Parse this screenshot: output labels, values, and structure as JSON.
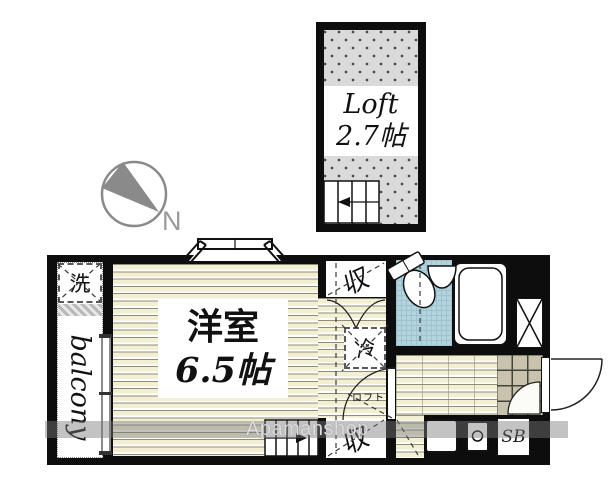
{
  "plan": {
    "loft": {
      "label": "Loft",
      "size": "2.7帖"
    },
    "main_room": {
      "label": "洋室",
      "size": "6.5帖"
    },
    "balcony": {
      "label": "balcony"
    },
    "washer": {
      "label": "洗"
    },
    "closet_top": {
      "label": "収"
    },
    "closet_bottom": {
      "label": "収"
    },
    "refrigerator": {
      "label": "冷"
    },
    "loft_ladder_note": {
      "label": "ロフト"
    },
    "shoe_box": {
      "label": "SB"
    },
    "compass": {
      "north_label": "N"
    }
  },
  "watermark": {
    "text": "Apamanshop"
  },
  "icons": [
    "compass-icon",
    "bay-window-icon",
    "stairs-ladder-icon",
    "toilet-icon",
    "sink-icon",
    "bathtub-icon",
    "pipe-shaft-icon",
    "door-swing-icon",
    "sliding-window-icon",
    "stove-icon",
    "kitchen-sink-icon"
  ],
  "colors": {
    "wall": "#0d0d0d",
    "flooring": "#f3efd2",
    "bathroom_tile": "#b3d4dd",
    "kitchen_tile": "#c9c2ac",
    "loft_floor": "#dadada",
    "compass_gray": "#8a8a8a",
    "watermark_gray": "#7a7a7a"
  }
}
